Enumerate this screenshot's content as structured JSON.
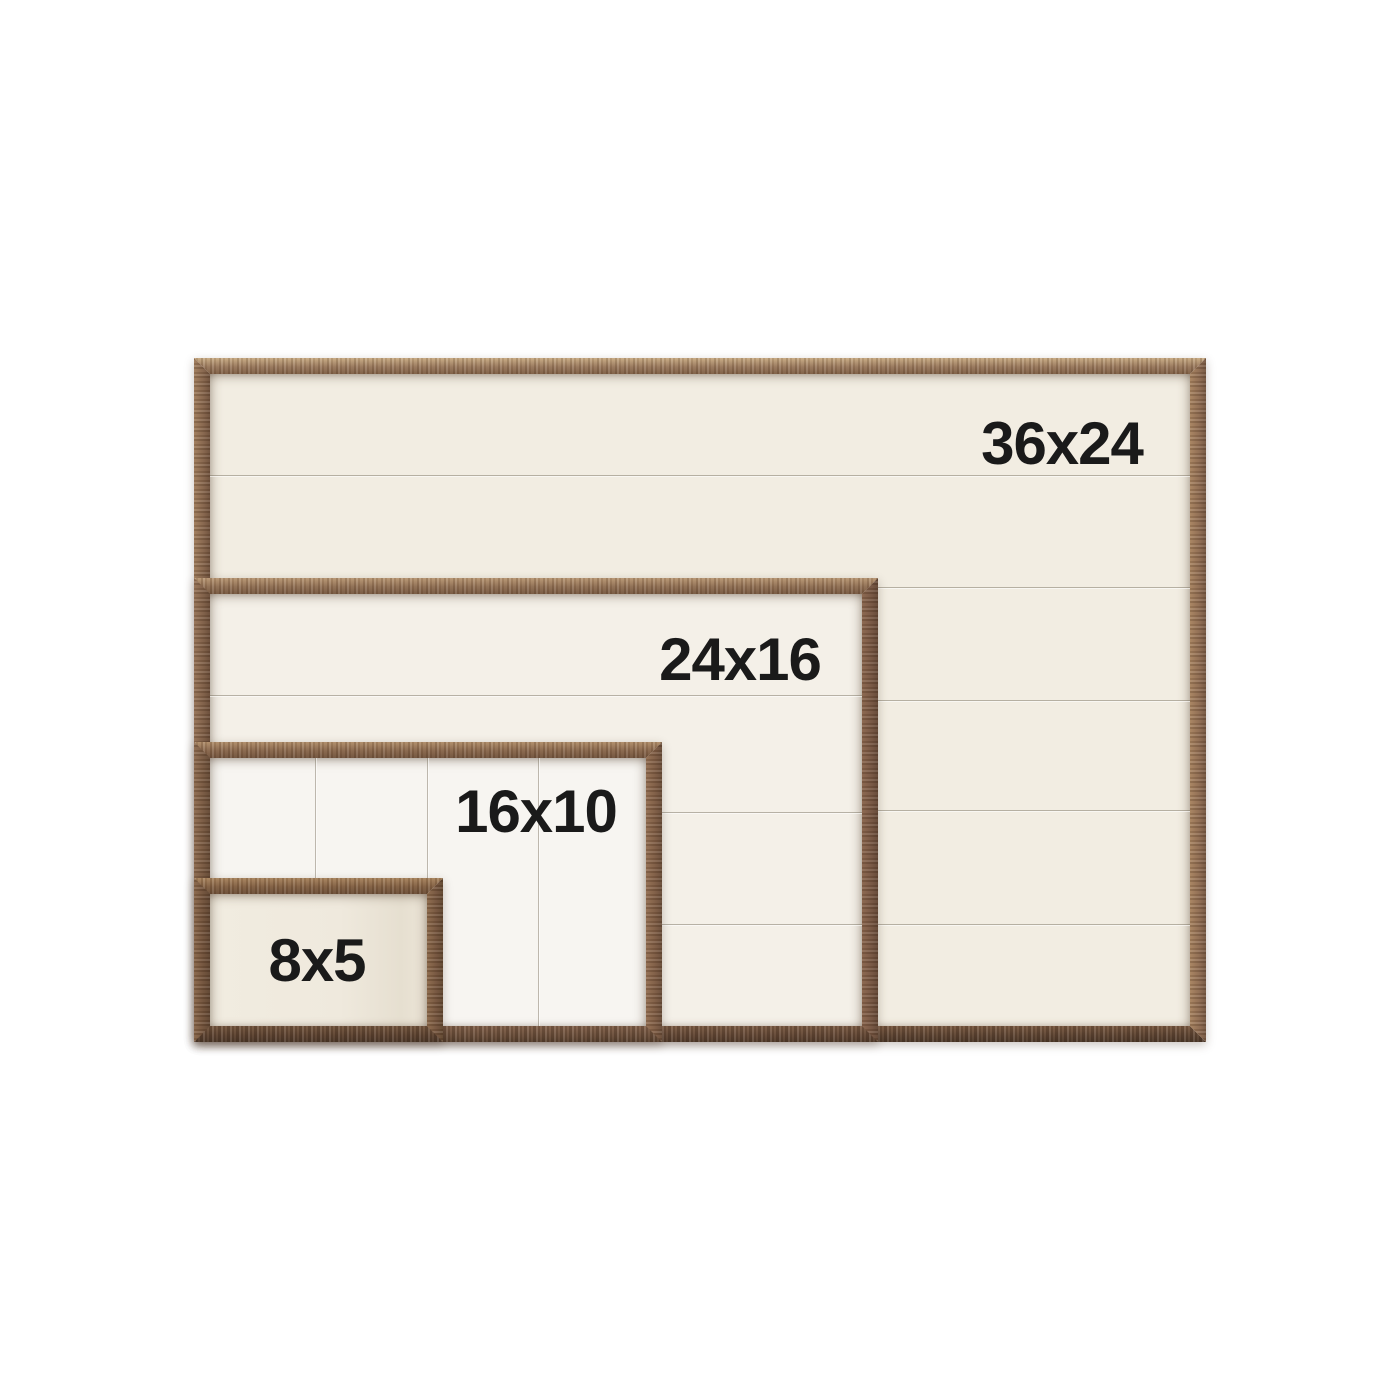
{
  "sizes": [
    {
      "label": "36x24",
      "width_in": 36,
      "height_in": 24
    },
    {
      "label": "24x16",
      "width_in": 24,
      "height_in": 16
    },
    {
      "label": "16x10",
      "width_in": 16,
      "height_in": 10
    },
    {
      "label": "8x5",
      "width_in": 8,
      "height_in": 5
    }
  ],
  "colors": {
    "background": "#ffffff",
    "label_text": "#1a1a1a",
    "wood_light": "#97765a",
    "wood_medium": "#7d5d45",
    "wood_dark": "#5e4533",
    "panel_cream": "#f2ede2",
    "panel_white": "#f7f5f1"
  }
}
